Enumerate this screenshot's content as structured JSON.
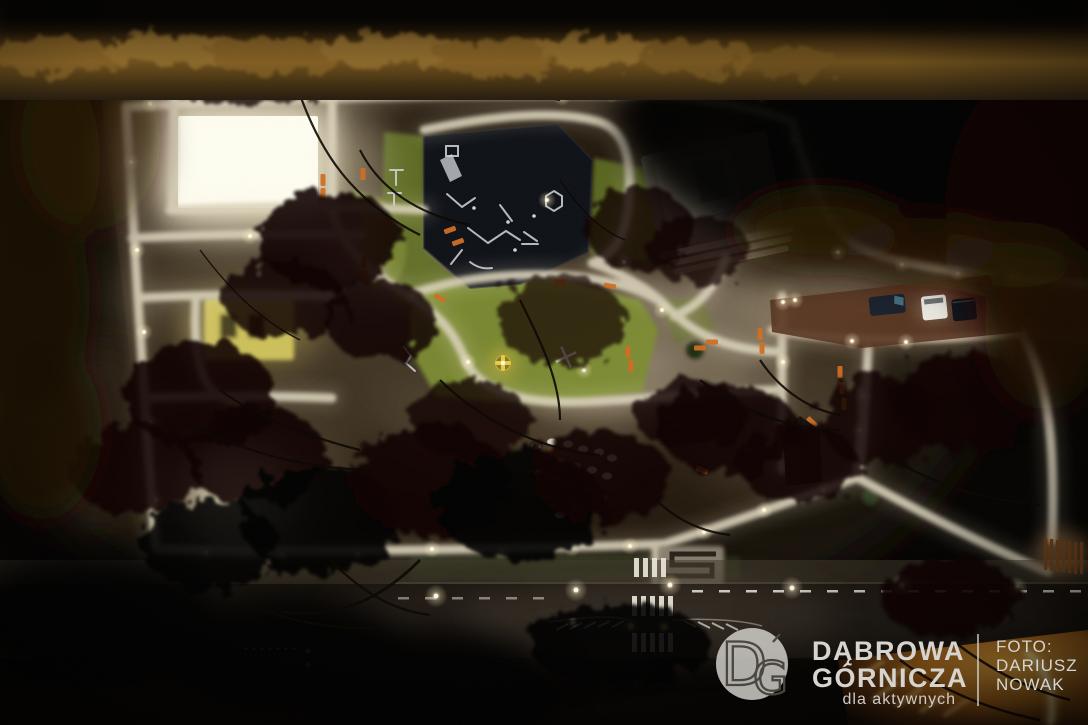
{
  "image": {
    "alt": "Night aerial drone photograph of an illuminated city park with lit footpaths, playground, sports court, monument plaza, parking, benches and a road with a pedestrian crossing"
  },
  "watermark": {
    "logo_monogram_d": "D",
    "logo_monogram_g": "G",
    "brand_line1": "DĄBROWA",
    "brand_line2": "GÓRNICZA",
    "tagline": "dla aktywnych",
    "credit_label": "FOTO:",
    "credit_name_line1": "DARIUSZ",
    "credit_name_line2": "NOWAK"
  },
  "colors": {
    "night_black": "#050302",
    "ground_dark": "#241a0f",
    "path_light": "#d9d1ba",
    "lamp_white": "#fff9e6",
    "grass_green": "#5f7026",
    "grass_bright": "#7c8c33",
    "court_white": "#fdfcf0",
    "court_yellow": "#d2c55e",
    "playground_surface": "#0e1117",
    "equipment_white": "#ccd1d8",
    "bench_orange": "#cf6e22",
    "marking_white": "#e9e6da",
    "road_asphalt": "#17120d",
    "parking_brown": "#4e2e1d",
    "monument_grey": "#847c6c",
    "shrub_ochre": "#8a6526",
    "ember_orange": "#e0861c",
    "watermark_text": "#d7d4cf",
    "watermark_circle": "#d8d5d0",
    "logo_stroke": "#4a4641"
  }
}
